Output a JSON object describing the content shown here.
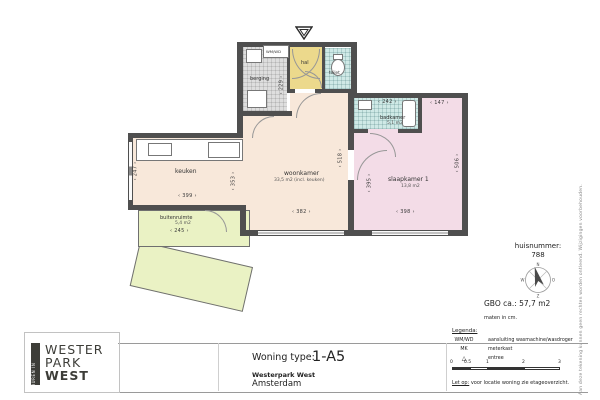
{
  "plan": {
    "rooms": {
      "berging": {
        "label": "berging"
      },
      "hal": {
        "label": "hal"
      },
      "toilet": {
        "label": "toilet"
      },
      "keuken": {
        "label": "keuken"
      },
      "woonkamer": {
        "label": "woonkamer",
        "area": "33,5 m2 (incl. keuken)"
      },
      "badkamer": {
        "label": "badkamer",
        "area": "5,1 m2"
      },
      "slaapkamer": {
        "label": "slaapkamer 1",
        "area": "13,8 m2"
      },
      "buitenruimte": {
        "label": "buitenruimte",
        "area": "5,4 m2"
      }
    },
    "dims": {
      "keuken_h": "247",
      "keuken_w": "399",
      "berging_h": "229",
      "woonkamer_h": "353",
      "woonkamer_w": "382",
      "woonkamer_h2": "518",
      "slaapkamer_h": "395",
      "slaapkamer_w": "398",
      "slaapkamer_h2": "506",
      "slaapkamer_top": "147",
      "badkamer_w": "242",
      "buitenruimte_w": "245"
    },
    "appliance": "WM/WD"
  },
  "title_block": {
    "type_label": "Woning type:",
    "type_value": "1-A5",
    "project": "Westerpark West",
    "city": "Amsterdam"
  },
  "info": {
    "huisnummer_label": "huisnummer:",
    "huisnummer": "788",
    "gbo": "GBO ca.:  57,7 m2",
    "maten": "maten in cm.",
    "compass": {
      "n": "N",
      "e": "O",
      "s": "Z",
      "w": "W"
    }
  },
  "legend": {
    "title": "Legenda:",
    "rows": [
      {
        "key": "WM/WD",
        "value": "aansluiting wasmachine/wasdroger"
      },
      {
        "key": "MK",
        "value": "meterkast"
      },
      {
        "key": "△",
        "value": "entree"
      }
    ],
    "scale_ticks": [
      "0",
      "0.5",
      "1",
      "2",
      "3"
    ],
    "note_label": "Let op:",
    "note": "voor locatie woning zie etageoverzicht."
  },
  "logo": {
    "vertical": "HUREN IN",
    "line1": "WESTER",
    "line2": "PARK",
    "line3": "WEST"
  },
  "disclaimer": "Aan deze tekening kunnen geen rechten worden ontleend. Wijzigingen voorbehouden.",
  "colors": {
    "wall": "#4f4f4f",
    "living": "#f8e8da",
    "bedroom": "#f3dce7",
    "hall": "#ecd98c",
    "wet_room": "#cfe9e6",
    "storage": "#dedede",
    "outdoor": "#eaf2c4"
  }
}
